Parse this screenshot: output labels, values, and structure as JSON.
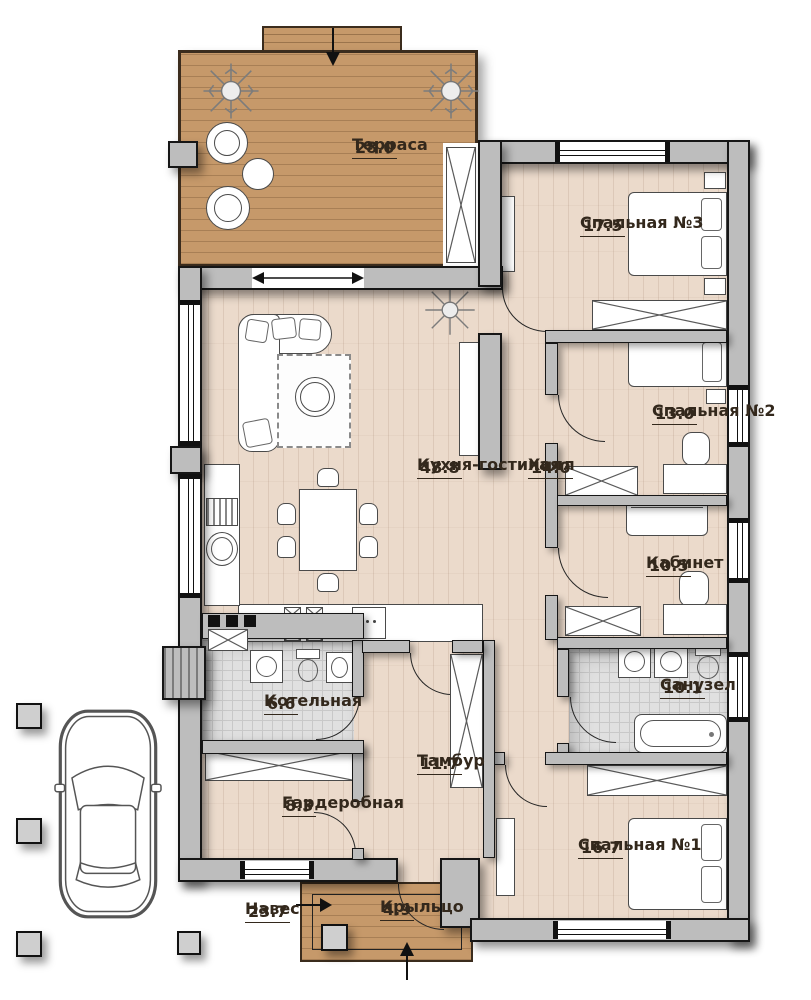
{
  "plan": {
    "type": "single-storey house floor plan",
    "language": "ru"
  },
  "colors": {
    "terrace_wood": "#c6996a",
    "interior_floor": "#ebdacb",
    "wall_gray": "#bdbdbd",
    "tile_gray": "#e0e0e0",
    "outline": "#161616",
    "label_text": "#33281c"
  },
  "rooms": [
    {
      "name": "Терраса",
      "area": "28.0"
    },
    {
      "name": "Спальная №3",
      "area": "17.5"
    },
    {
      "name": "Кухня-гостиная",
      "area": "48.8"
    },
    {
      "name": "Холл",
      "area": "14.0"
    },
    {
      "name": "Спальная №2",
      "area": "13.0"
    },
    {
      "name": "Кабинет",
      "area": "10.5"
    },
    {
      "name": "Санузел",
      "area": "10.1"
    },
    {
      "name": "Котельная",
      "area": "6.6"
    },
    {
      "name": "Тамбур",
      "area": "11.7"
    },
    {
      "name": "Гардеробная",
      "area": "8.3"
    },
    {
      "name": "Спальная №1",
      "area": "16.7"
    },
    {
      "name": "Навес",
      "area": "23.7"
    },
    {
      "name": "Крыльцо",
      "area": "4.9"
    }
  ]
}
